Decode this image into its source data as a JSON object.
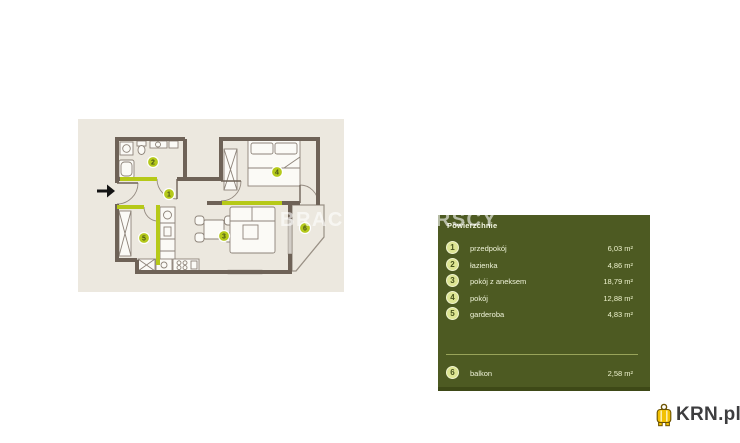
{
  "watermark": {
    "text": "BRACIA SADURSCY"
  },
  "floorplan": {
    "markers": [
      "1",
      "2",
      "3",
      "4",
      "5",
      "6"
    ]
  },
  "legend": {
    "title": "Powierzchnie",
    "rows": [
      {
        "num": "1",
        "label": "przedpokój",
        "area": "6,03 m²"
      },
      {
        "num": "2",
        "label": "łazienka",
        "area": "4,86 m²"
      },
      {
        "num": "3",
        "label": "pokój z aneksem",
        "area": "18,79 m²"
      },
      {
        "num": "4",
        "label": "pokój",
        "area": "12,88 m²"
      },
      {
        "num": "5",
        "label": "garderoba",
        "area": "4,83 m²"
      }
    ],
    "balcony_row": {
      "num": "6",
      "label": "balkon",
      "area": "2,58 m²"
    }
  },
  "logo": {
    "text": "KRN.pl"
  },
  "colors": {
    "accent": "#b6c918",
    "panel": "#4d5a22",
    "wall": "#6e6257",
    "canvas": "#ece8df"
  }
}
